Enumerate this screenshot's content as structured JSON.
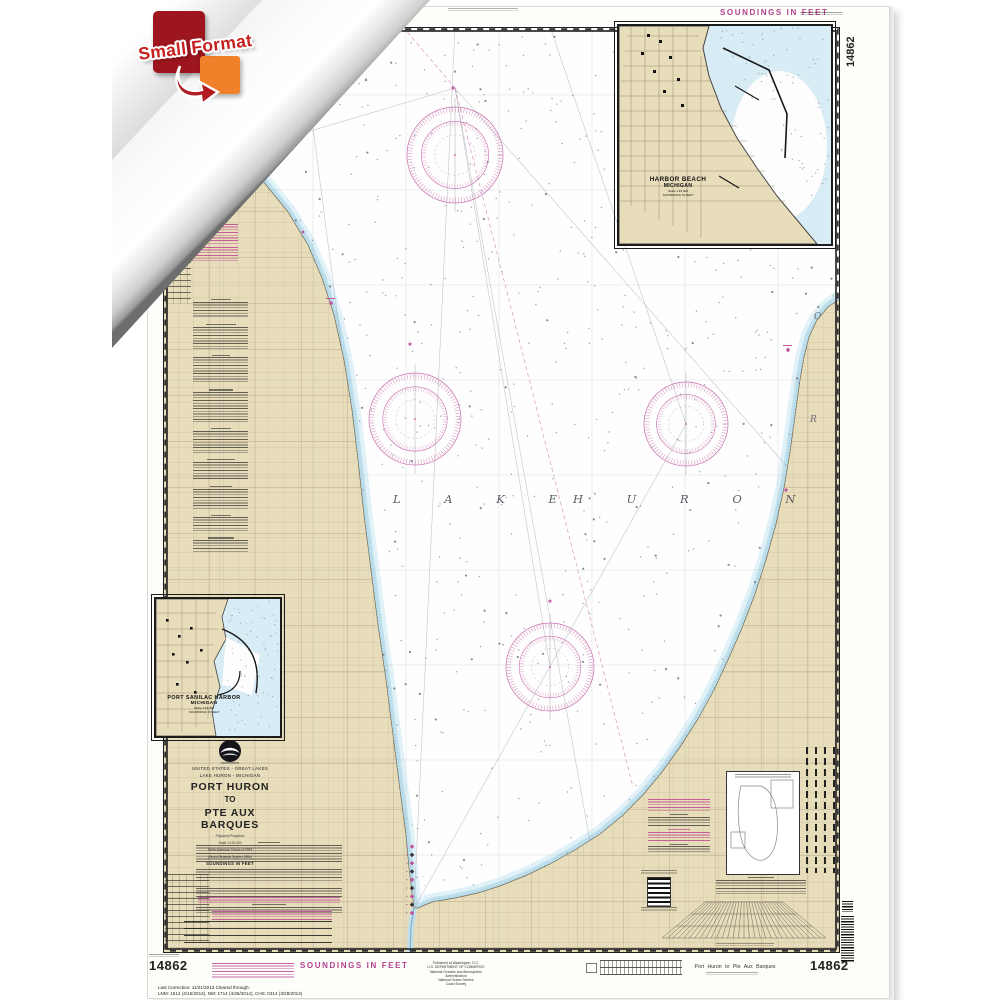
{
  "colors": {
    "magenta": "#b3438f",
    "land": "#e8ddbb",
    "shallow": "#bfe0ec",
    "badge_red": "#9d151d",
    "badge_orange": "#f0802a"
  },
  "badge": {
    "label": "Small Format"
  },
  "top_margin": {
    "soundings_label": "SOUNDINGS IN FEET",
    "chart_number": "14862"
  },
  "main_map": {
    "lake_word1": "L A K E",
    "lake_word2": "H U R O N",
    "letter_o": "O",
    "letter_r": "R"
  },
  "insets": {
    "harbor_beach": {
      "line1": "HARBOR BEACH",
      "line2": "MICHIGAN",
      "scale": "Scale 1:15,000",
      "soundings": "SOUNDINGS IN FEET"
    },
    "port_sanilac": {
      "line1": "PORT SANILAC HARBOR",
      "line2": "MICHIGAN",
      "scale": "Scale 1:10,000",
      "soundings": "SOUNDINGS IN FEET"
    }
  },
  "title_block": {
    "nation_line": "UNITED STATES - GREAT LAKES",
    "region_line": "LAKE HURON - MICHIGAN",
    "title_line1": "PORT HURON",
    "title_line2": "TO",
    "title_line3": "PTE AUX BARQUES",
    "projection_lines": [
      "Polyconic Projection",
      "Scale 1:120,000",
      "North American Datum of 1983",
      "(World Geodetic System 1984)"
    ],
    "soundings_label": "SOUNDINGS IN FEET"
  },
  "bottom_margin": {
    "chart_number_left": "14862",
    "soundings_label": "SOUNDINGS IN FEET",
    "imprint_lines": [
      "Published at Washington, D.C.",
      "U.S. DEPARTMENT OF COMMERCE",
      "National Oceanic and Atmospheric Administration",
      "National Ocean Service",
      "Coast Survey"
    ],
    "correction_line1": "Last Correction: 11/21/2013   Cleared through:",
    "correction_line2": "LNM: 1514 (4/15/2014), NM: 1714 (4/26/2014), CHS: 0314 (3/28/2014)",
    "chart_title_right": "Port Huron to Pte Aux Barques",
    "chart_number_right": "14862"
  }
}
